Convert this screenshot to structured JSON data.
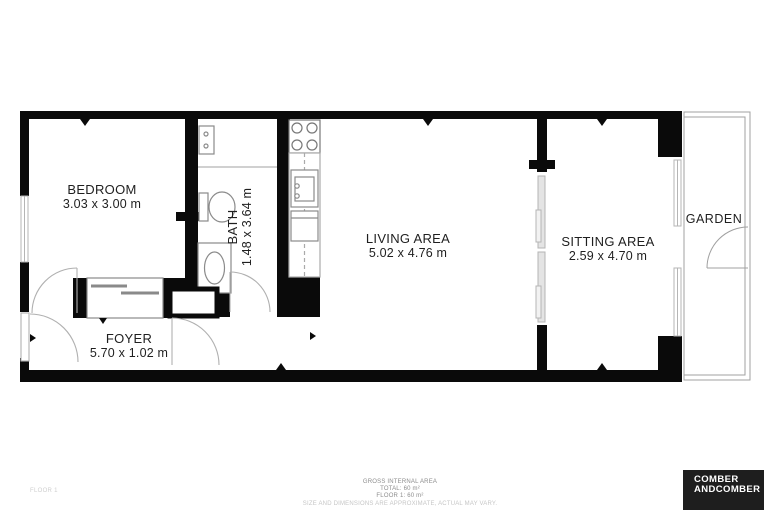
{
  "rooms": {
    "bedroom": {
      "name": "BEDROOM",
      "dims": "3.03 x 3.00 m"
    },
    "bath": {
      "name": "BATH",
      "dims": "1.48 x 3.64 m"
    },
    "living": {
      "name": "LIVING AREA",
      "dims": "5.02 x 4.76 m"
    },
    "sitting": {
      "name": "SITTING AREA",
      "dims": "2.59 x 4.70 m"
    },
    "foyer": {
      "name": "FOYER",
      "dims": "5.70 x 1.02 m"
    },
    "garden": {
      "name": "GARDEN"
    }
  },
  "footer": {
    "floor_label": "FLOOR 1",
    "area_title": "GROSS INTERNAL AREA",
    "area_total": "TOTAL: 60 m²",
    "area_floor": "FLOOR 1: 60 m²",
    "disclaimer": "SIZE AND DIMENSIONS ARE APPROXIMATE, ACTUAL MAY VARY."
  },
  "logo": {
    "line1": "COMBER",
    "line2": "ANDCOMBER"
  },
  "colors": {
    "wall": "#0a0a0a",
    "fixture": "#8a8a8a",
    "thin": "#b5b5b5",
    "door": "#b0b0b0",
    "logo_bg": "#1e1e1e"
  }
}
